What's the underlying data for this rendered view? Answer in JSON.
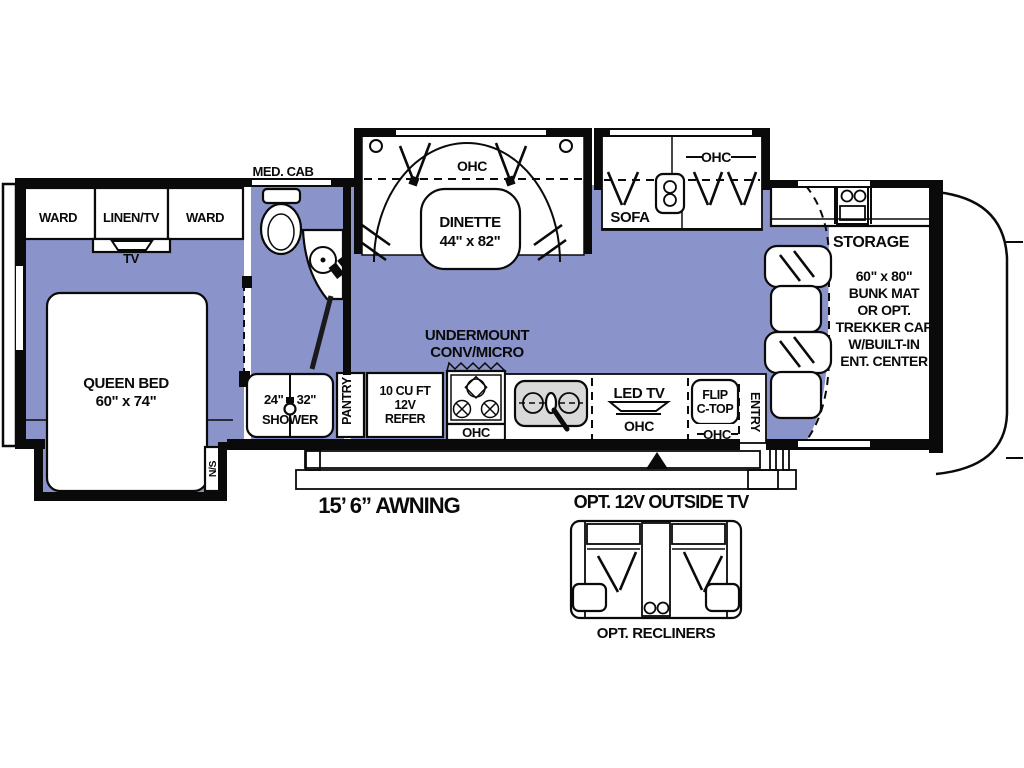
{
  "plan_title": "RV floor plan",
  "bedroom": {
    "ward_left": "WARD",
    "linen_tv": "LINEN/TV",
    "ward_right": "WARD",
    "tv": "TV",
    "bed_line1": "QUEEN BED",
    "bed_line2": "60\" x 74\"",
    "nightstand": "N/S"
  },
  "bath": {
    "med_cab": "MED. CAB",
    "shower_line1": "24\" x 32\"",
    "shower_line2": "SHOWER"
  },
  "kitchen": {
    "pantry": "PANTRY",
    "refer_line1": "10 CU FT",
    "refer_line2": "12V",
    "refer_line3": "REFER",
    "undermount_line1": "UNDERMOUNT",
    "undermount_line2": "CONV/MICRO",
    "stove_ohc": "OHC",
    "led_tv": "LED TV",
    "tv_ohc": "OHC",
    "flip_line1": "FLIP",
    "flip_line2": "C-TOP",
    "flip_ohc": "OHC",
    "entry": "ENTRY"
  },
  "dinette": {
    "ohc": "OHC",
    "line1": "DINETTE",
    "line2": "44\" x 82\""
  },
  "sofa": {
    "label": "SOFA",
    "ohc": "OHC"
  },
  "cab": {
    "storage": "STORAGE",
    "bunk_line1": "60\" x 80\"",
    "bunk_line2": "BUNK MAT",
    "bunk_line3": "OR OPT.",
    "bunk_line4": "TREKKER CAP",
    "bunk_line5": "W/BUILT-IN",
    "bunk_line6": "ENT. CENTER"
  },
  "exterior": {
    "awning": "15’ 6” AWNING",
    "outside_tv": "OPT. 12V OUTSIDE TV",
    "recliners": "OPT. RECLINERS"
  },
  "colors": {
    "floor": "#8a94ca",
    "sink": "#d9d9d9",
    "wall": "#0a0a0a",
    "background": "#ffffff"
  }
}
